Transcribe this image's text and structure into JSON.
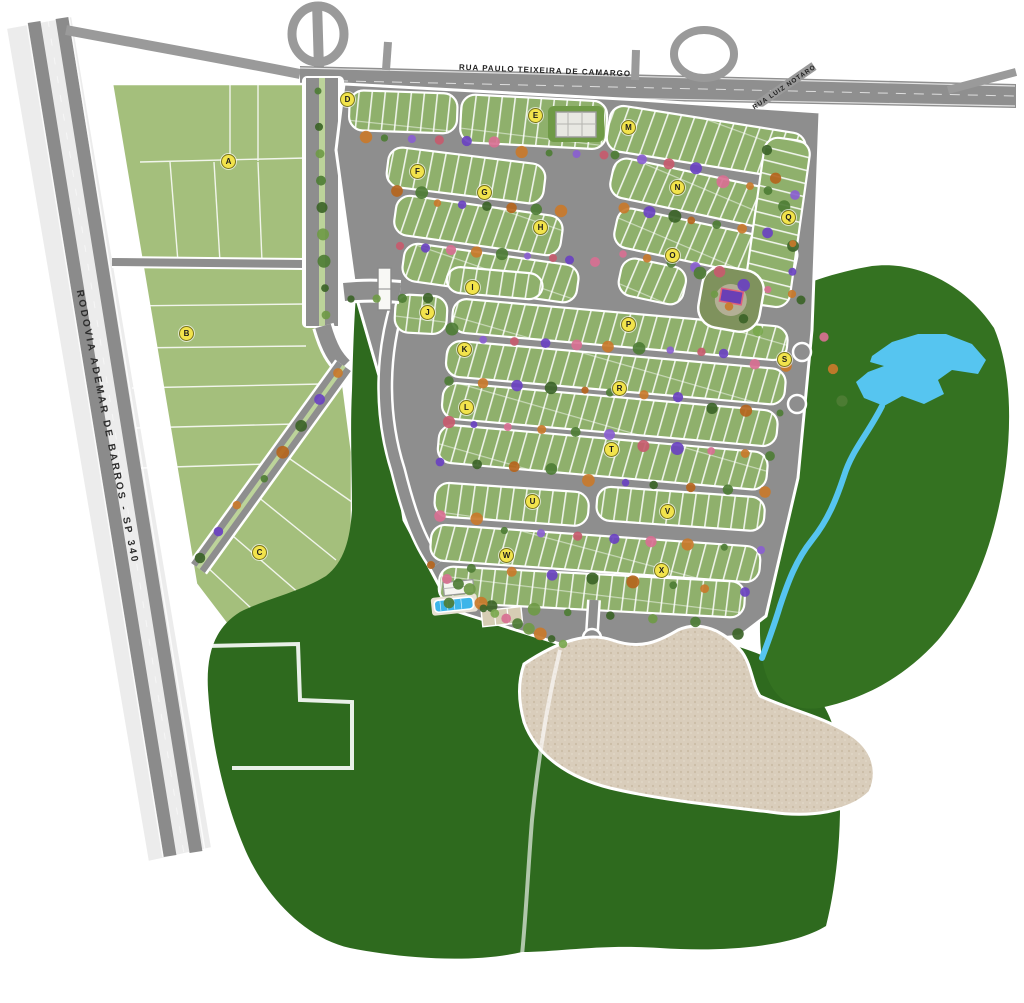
{
  "map": {
    "roads": {
      "top_road_label": "RUA PAULO TEIXEIRA DE CAMARGO",
      "highway_label": "RODOVIA ADEMAR DE BARROS - SP 340",
      "side_street_label": "RUA LUIZ NOTARO"
    },
    "blocks": [
      {
        "letter": "A",
        "x": 228,
        "y": 161
      },
      {
        "letter": "B",
        "x": 186,
        "y": 333
      },
      {
        "letter": "C",
        "x": 259,
        "y": 552
      },
      {
        "letter": "D",
        "x": 347,
        "y": 99
      },
      {
        "letter": "E",
        "x": 535,
        "y": 115
      },
      {
        "letter": "F",
        "x": 417,
        "y": 171
      },
      {
        "letter": "G",
        "x": 484,
        "y": 192
      },
      {
        "letter": "H",
        "x": 540,
        "y": 227
      },
      {
        "letter": "I",
        "x": 472,
        "y": 287
      },
      {
        "letter": "J",
        "x": 427,
        "y": 312
      },
      {
        "letter": "K",
        "x": 464,
        "y": 349
      },
      {
        "letter": "L",
        "x": 466,
        "y": 407
      },
      {
        "letter": "M",
        "x": 628,
        "y": 127
      },
      {
        "letter": "N",
        "x": 677,
        "y": 187
      },
      {
        "letter": "O",
        "x": 672,
        "y": 255
      },
      {
        "letter": "P",
        "x": 628,
        "y": 324
      },
      {
        "letter": "Q",
        "x": 788,
        "y": 217
      },
      {
        "letter": "R",
        "x": 619,
        "y": 388
      },
      {
        "letter": "S",
        "x": 784,
        "y": 359
      },
      {
        "letter": "T",
        "x": 611,
        "y": 449
      },
      {
        "letter": "U",
        "x": 532,
        "y": 501
      },
      {
        "letter": "V",
        "x": 667,
        "y": 511
      },
      {
        "letter": "W",
        "x": 506,
        "y": 555
      },
      {
        "letter": "X",
        "x": 661,
        "y": 570
      }
    ],
    "features": [
      "gatehouse",
      "clubhouse",
      "swimming-pool",
      "sports-courts",
      "playground",
      "lake",
      "stream",
      "forest-reserve",
      "future-phase-area",
      "boulevard-median",
      "highway-interchange"
    ],
    "colors": {
      "road": "#8e8e8e",
      "lot_green": "#8fb06c",
      "chacara_green": "#a4bf7c",
      "forest_green": "#2e6a1e",
      "water_blue": "#56c5f0",
      "sand": "#d9cdbb",
      "badge_yellow": "#f2e34c"
    }
  }
}
